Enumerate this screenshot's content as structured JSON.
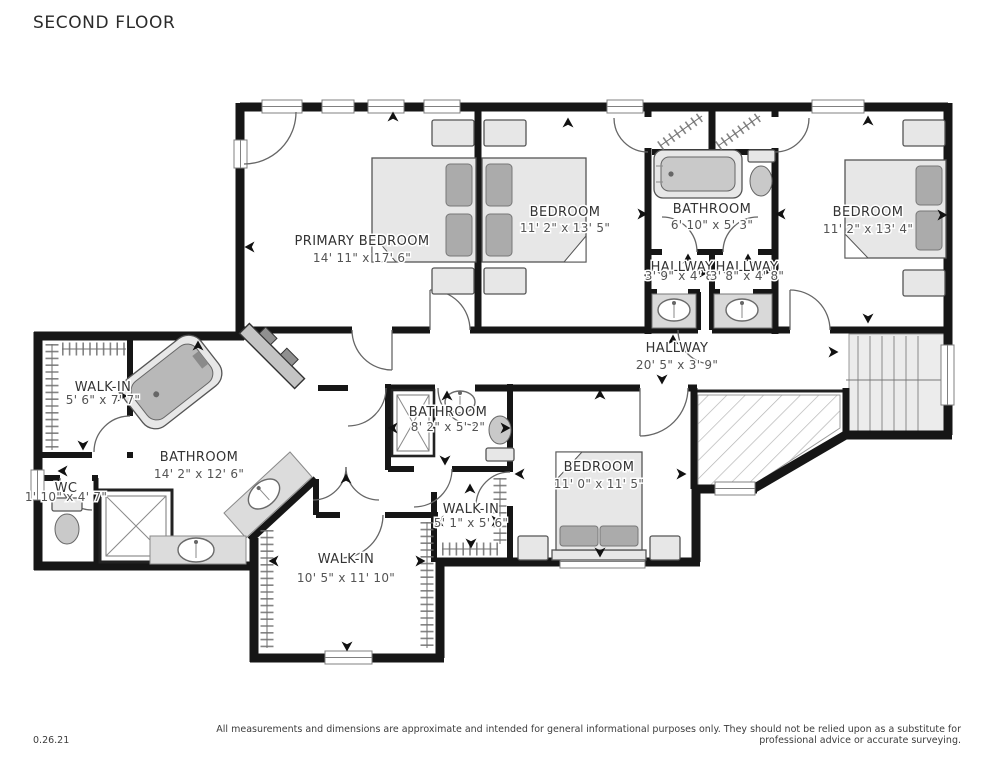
{
  "title": "SECOND FLOOR",
  "footer": {
    "date": "0.26.21",
    "disclaimer": "All measurements and dimensions are approximate and intended for general informational purposes only. They should not be relied upon as a substitute for professional advice or accurate surveying."
  },
  "rooms": {
    "primary_bedroom": {
      "name": "PRIMARY BEDROOM",
      "dims": "14' 11\" x 17' 6\""
    },
    "bedroom_top_middle": {
      "name": "BEDROOM",
      "dims": "11' 2\" x 13' 5\""
    },
    "bathroom_top": {
      "name": "BATHROOM",
      "dims": "6' 10\" x 5' 3\""
    },
    "bedroom_top_right": {
      "name": "BEDROOM",
      "dims": "11' 2\" x 13' 4\""
    },
    "hallway_jack_left": {
      "name": "HALLWAY",
      "dims": "3' 9\" x 4' 8\""
    },
    "hallway_jack_right": {
      "name": "HALLWAY",
      "dims": "3' 8\" x 4' 8\""
    },
    "hallway_main": {
      "name": "HALLWAY",
      "dims": "20' 5\" x 3' 9\""
    },
    "walk_in_left": {
      "name": "WALK-IN",
      "dims": "5' 6\" x 7' 7\""
    },
    "bathroom_primary": {
      "name": "BATHROOM",
      "dims": "14' 2\" x 12' 6\""
    },
    "wc": {
      "name": "WC",
      "dims": "1' 10\" x 4' 7\""
    },
    "bathroom_center": {
      "name": "BATHROOM",
      "dims": "8' 2\" x 5' 2\""
    },
    "walk_in_center": {
      "name": "WALK-IN",
      "dims": "5' 1\" x 5' 6\""
    },
    "bedroom_bottom": {
      "name": "BEDROOM",
      "dims": "11' 0\" x 11' 5\""
    },
    "walk_in_bottom": {
      "name": "WALK-IN",
      "dims": "10' 5\" x 11' 10\""
    }
  },
  "colors": {
    "wall": "#161616",
    "furniture_light": "#e7e7e7",
    "furniture_mid": "#c9c9c9",
    "furniture_dark": "#ababab",
    "hatch_line": "#b5b5b5",
    "label_text": "#333333",
    "dims_text": "#545454"
  }
}
